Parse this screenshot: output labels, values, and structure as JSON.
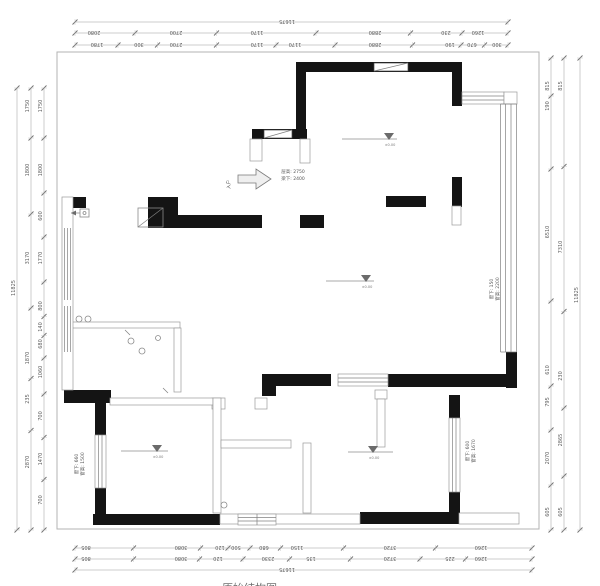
{
  "plan": {
    "annotations": {
      "entry_label": "入户",
      "note_center": [
        "层高: 2750",
        "梁下: 2400"
      ],
      "note_window_left": [
        "窗下: 660",
        "窗高: 1500"
      ],
      "note_window_right": [
        "窗下: 150",
        "窗高: 2200"
      ],
      "note_window_bottom_right": [
        "窗下: 600",
        "窗高: 1670"
      ],
      "level_label": "±0.00",
      "title_fragment": "原始结构图"
    },
    "colors": {
      "wall": "#141414",
      "dim_text": "#5c5c5c",
      "line": "#9a9a9a"
    }
  },
  "dimensions": {
    "chains": [
      {
        "name": "dim-top-total",
        "axis": "h",
        "pos": 22,
        "from": 75,
        "to": 508,
        "rot": 180,
        "labels": [
          {
            "v": "11675",
            "p": 287
          }
        ]
      },
      {
        "name": "dim-top-outer",
        "axis": "h",
        "pos": 33,
        "from": 75,
        "to": 508,
        "rot": 180,
        "labels": [
          {
            "v": "2080",
            "p": 94
          },
          {
            "v": "2700",
            "p": 176
          },
          {
            "v": "1170",
            "p": 257
          },
          {
            "v": "2880",
            "p": 375
          },
          {
            "v": "230",
            "p": 446
          },
          {
            "v": "1260",
            "p": 478
          }
        ]
      },
      {
        "name": "dim-top-inner",
        "axis": "h",
        "pos": 45,
        "from": 75,
        "to": 508,
        "rot": 180,
        "labels": [
          {
            "v": "1780",
            "p": 97
          },
          {
            "v": "300",
            "p": 139
          },
          {
            "v": "2700",
            "p": 176
          },
          {
            "v": "1170",
            "p": 257
          },
          {
            "v": "1170",
            "p": 295
          },
          {
            "v": "2880",
            "p": 375
          },
          {
            "v": "190",
            "p": 450
          },
          {
            "v": "670",
            "p": 472
          },
          {
            "v": "300",
            "p": 497
          }
        ]
      },
      {
        "name": "dim-left-total",
        "axis": "v",
        "pos": 17,
        "from": 88,
        "to": 530,
        "rot": -90,
        "labels": [
          {
            "v": "11825",
            "p": 288
          }
        ]
      },
      {
        "name": "dim-left-outer",
        "axis": "v",
        "pos": 31,
        "from": 88,
        "to": 530,
        "rot": -90,
        "labels": [
          {
            "v": "1750",
            "p": 106
          },
          {
            "v": "1800",
            "p": 170
          },
          {
            "v": "3170",
            "p": 258
          },
          {
            "v": "1870",
            "p": 358
          },
          {
            "v": "235",
            "p": 399
          },
          {
            "v": "2870",
            "p": 462
          }
        ]
      },
      {
        "name": "dim-left-inner",
        "axis": "v",
        "pos": 44,
        "from": 88,
        "to": 530,
        "rot": -90,
        "labels": [
          {
            "v": "1750",
            "p": 106
          },
          {
            "v": "1800",
            "p": 170
          },
          {
            "v": "600",
            "p": 216
          },
          {
            "v": "1770",
            "p": 258
          },
          {
            "v": "800",
            "p": 306
          },
          {
            "v": "140",
            "p": 327
          },
          {
            "v": "680",
            "p": 344
          },
          {
            "v": "1060",
            "p": 372
          },
          {
            "v": "700",
            "p": 416
          },
          {
            "v": "1470",
            "p": 459
          },
          {
            "v": "700",
            "p": 500
          }
        ]
      },
      {
        "name": "dim-right-inner",
        "axis": "v",
        "pos": 551,
        "from": 58,
        "to": 530,
        "rot": -90,
        "labels": [
          {
            "v": "815",
            "p": 86
          },
          {
            "v": "190",
            "p": 106
          },
          {
            "v": "6510",
            "p": 232
          },
          {
            "v": "610",
            "p": 370
          },
          {
            "v": "795",
            "p": 402
          },
          {
            "v": "2070",
            "p": 458
          },
          {
            "v": "605",
            "p": 512
          }
        ]
      },
      {
        "name": "dim-right-outer",
        "axis": "v",
        "pos": 564,
        "from": 58,
        "to": 530,
        "rot": -90,
        "labels": [
          {
            "v": "815",
            "p": 86
          },
          {
            "v": "7310",
            "p": 247
          },
          {
            "v": "230",
            "p": 376
          },
          {
            "v": "2865",
            "p": 440
          },
          {
            "v": "605",
            "p": 512
          }
        ]
      },
      {
        "name": "dim-right-total",
        "axis": "v",
        "pos": 580,
        "from": 58,
        "to": 530,
        "rot": -90,
        "labels": [
          {
            "v": "11825",
            "p": 295
          }
        ]
      },
      {
        "name": "dim-bottom-inner",
        "axis": "h",
        "pos": 548,
        "from": 75,
        "to": 532,
        "rot": 180,
        "labels": [
          {
            "v": "805",
            "p": 86
          },
          {
            "v": "3080",
            "p": 181
          },
          {
            "v": "120",
            "p": 220
          },
          {
            "v": "500",
            "p": 236
          },
          {
            "v": "680",
            "p": 264
          },
          {
            "v": "1150",
            "p": 297
          },
          {
            "v": "3720",
            "p": 390
          },
          {
            "v": "1260",
            "p": 481
          }
        ]
      },
      {
        "name": "dim-bottom-outer",
        "axis": "h",
        "pos": 559,
        "from": 75,
        "to": 532,
        "rot": 180,
        "labels": [
          {
            "v": "805",
            "p": 86
          },
          {
            "v": "3080",
            "p": 181
          },
          {
            "v": "120",
            "p": 218
          },
          {
            "v": "2330",
            "p": 268
          },
          {
            "v": "135",
            "p": 311
          },
          {
            "v": "3720",
            "p": 390
          },
          {
            "v": "225",
            "p": 450
          },
          {
            "v": "1260",
            "p": 481
          }
        ]
      },
      {
        "name": "dim-bottom-total",
        "axis": "h",
        "pos": 570,
        "from": 75,
        "to": 532,
        "rot": 180,
        "labels": [
          {
            "v": "11675",
            "p": 287
          }
        ]
      }
    ]
  }
}
